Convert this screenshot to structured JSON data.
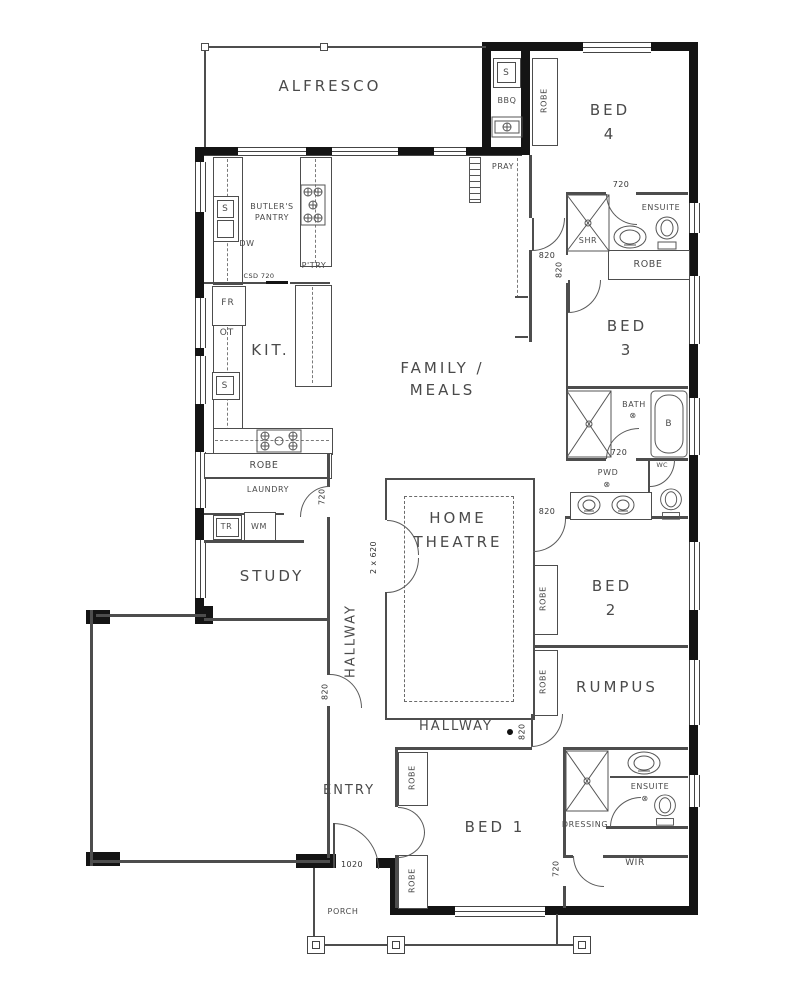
{
  "rooms": {
    "alfresco": "ALFRESCO",
    "bed4_l1": "BED",
    "bed4_l2": "4",
    "bed3_l1": "BED",
    "bed3_l2": "3",
    "bed2_l1": "BED",
    "bed2_l2": "2",
    "bed1": "BED 1",
    "family_l1": "FAMILY /",
    "family_l2": "MEALS",
    "theatre_l1": "HOME",
    "theatre_l2": "THEATRE",
    "kitchen": "KIT.",
    "butlers_l1": "BUTLER'S",
    "butlers_l2": "PANTRY",
    "pantry": "P'TRY",
    "laundry": "LAUNDRY",
    "study": "STUDY",
    "entry": "ENTRY",
    "porch": "PORCH",
    "hallway": "HALLWAY",
    "rumpus": "RUMPUS",
    "pray": "PRAY",
    "ensuite": "ENSUITE",
    "robe": "ROBE",
    "dressing": "DRESSING",
    "wir": "WIR",
    "pwd": "PWD",
    "wc": "WC",
    "bath": "BATH",
    "shr": "SHR"
  },
  "fixtures": {
    "sink": "S",
    "dishwasher": "DW",
    "fridge": "FR",
    "oven_tower": "OT",
    "trough": "TR",
    "washing_machine": "WM",
    "bbq": "BBQ",
    "bathtub": "B",
    "drain": "⊗"
  },
  "dimensions": {
    "d720": "720",
    "d820": "820",
    "d1020": "1020",
    "d2x620": "2 x 620",
    "csd720": "CSD 720"
  },
  "colors": {
    "wall": "#141414",
    "line": "#4d4d4d",
    "text": "#4a4a4a"
  }
}
